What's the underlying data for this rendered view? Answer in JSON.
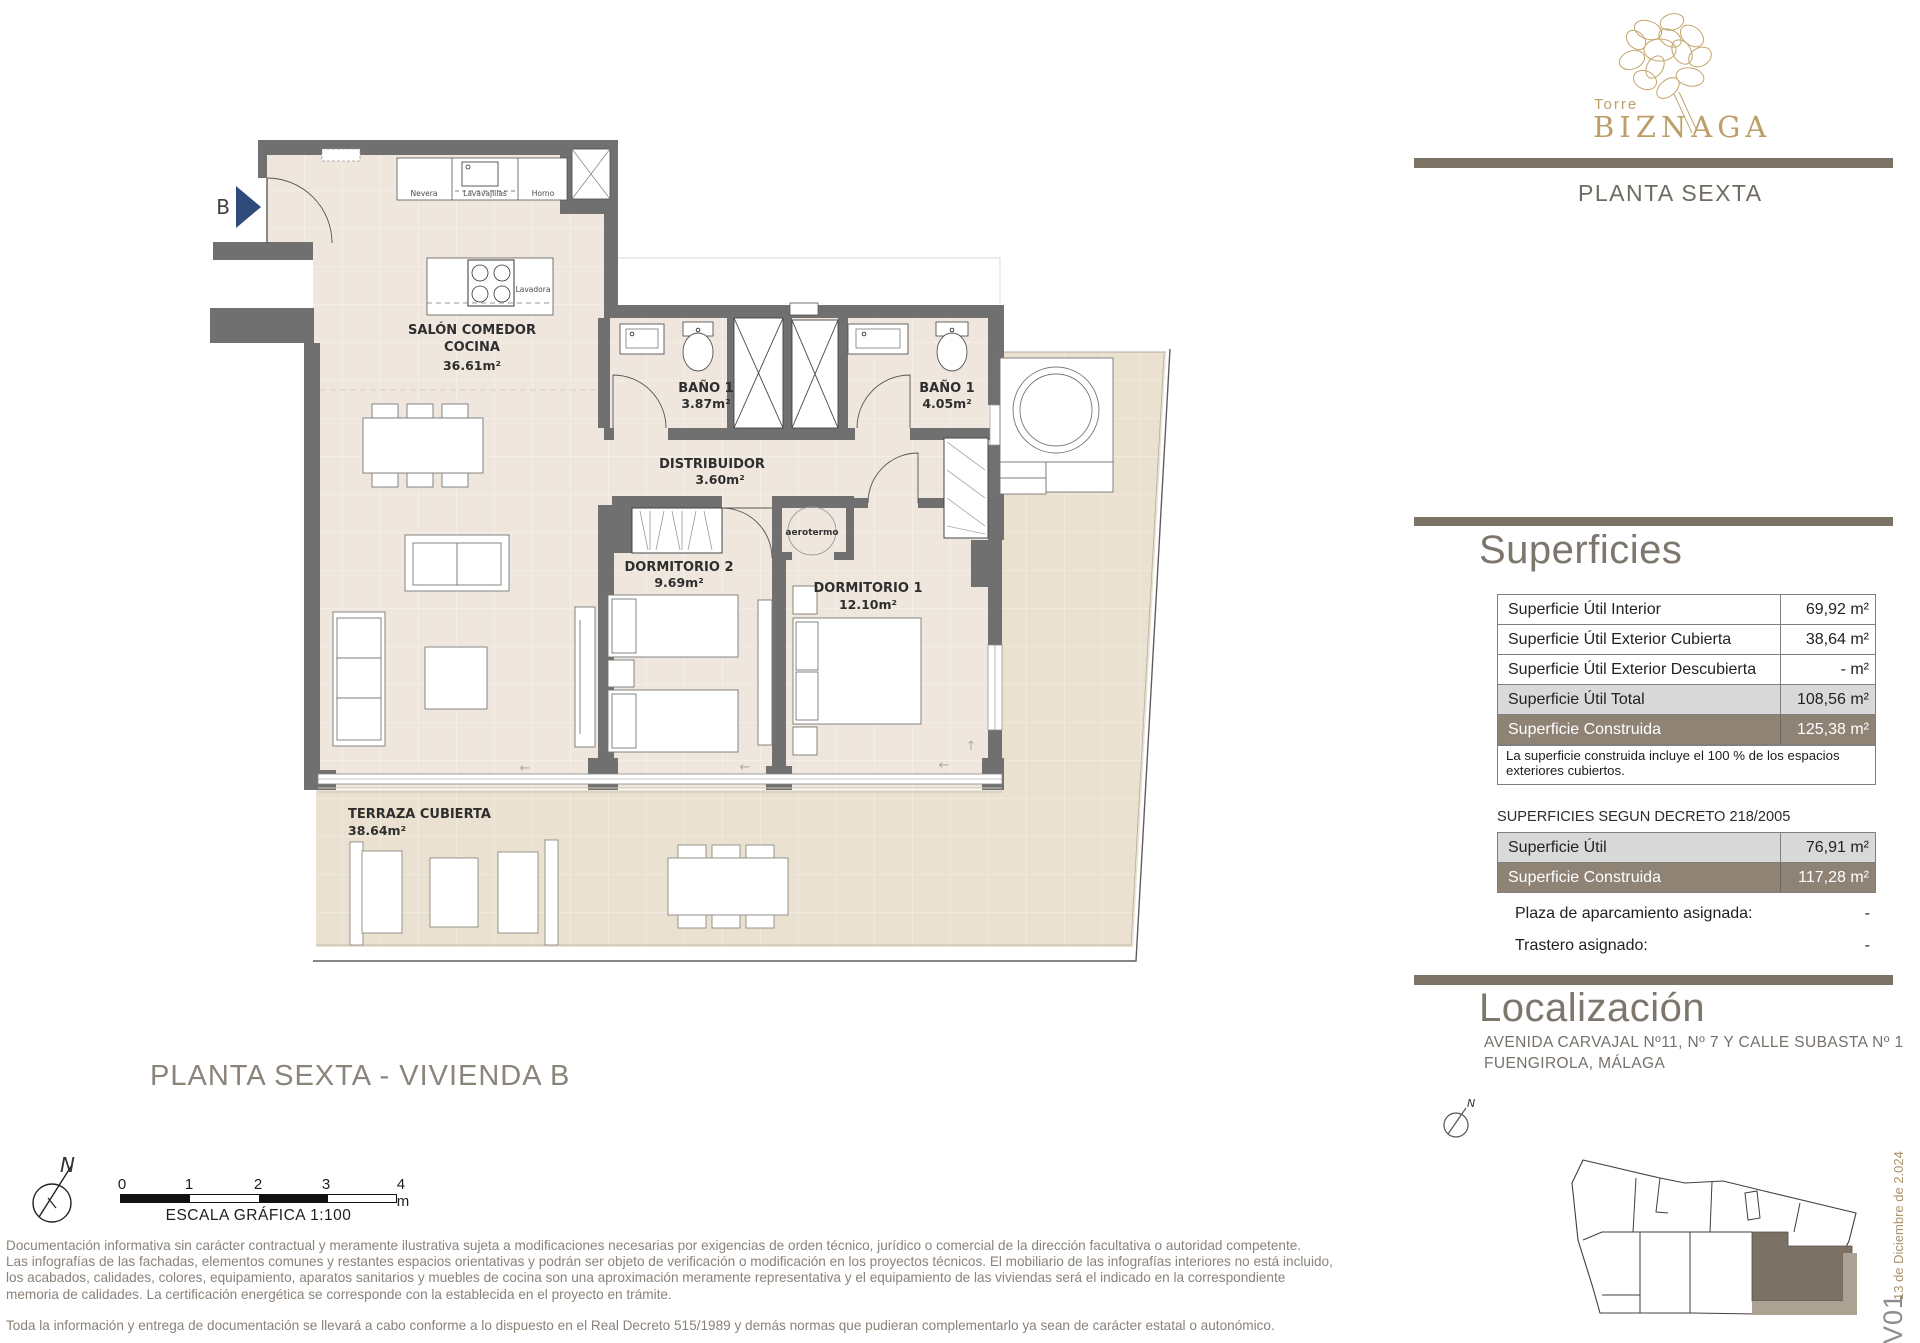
{
  "brand": {
    "top": "Torre",
    "name": "BIZNAGA",
    "floor": "PLANTA SEXTA"
  },
  "title": "PLANTA SEXTA - VIVIENDA B",
  "plan": {
    "entrance_label": "B",
    "rooms": [
      {
        "name": "SALÓN COMEDOR",
        "name2": "COCINA",
        "area": "36.61m²"
      },
      {
        "name": "BAÑO 1",
        "area": "3.87m²"
      },
      {
        "name": "BAÑO 1",
        "area": "4.05m²"
      },
      {
        "name": "DISTRIBUIDOR",
        "area": "3.60m²"
      },
      {
        "name": "DORMITORIO 2",
        "area": "9.69m²"
      },
      {
        "name": "DORMITORIO 1",
        "area": "12.10m²"
      },
      {
        "name": "TERRAZA CUBIERTA",
        "area": "38.64m²"
      }
    ],
    "appliances": {
      "fridge": "Nevera",
      "dishwasher": "Lavavajillas",
      "oven": "Horno",
      "washer": "Lavadora",
      "heater": "aerotermo"
    }
  },
  "north_label": "N",
  "scale_bar": {
    "ticks": [
      "0",
      "1",
      "2",
      "3",
      "4 m"
    ],
    "caption": "ESCALA GRÁFICA  1:100"
  },
  "superficies": {
    "heading": "Superficies",
    "rows": [
      {
        "label": "Superficie Útil Interior",
        "value": "69,92 m²"
      },
      {
        "label": "Superficie Útil Exterior Cubierta",
        "value": "38,64 m²"
      },
      {
        "label": "Superficie Útil Exterior Descubierta",
        "value": "- m²"
      },
      {
        "label": "Superficie Útil Total",
        "value": "108,56 m²"
      },
      {
        "label": "Superficie Construida",
        "value": "125,38 m²"
      }
    ],
    "note": "La superficie construida incluye el 100 % de los espacios exteriores cubiertos.",
    "decreto_title": "SUPERFICIES SEGUN DECRETO 218/2005",
    "decreto_rows": [
      {
        "label": "Superficie Útil",
        "value": "76,91 m²"
      },
      {
        "label": "Superficie Construida",
        "value": "117,28 m²"
      }
    ],
    "extras": [
      {
        "label": "Plaza de aparcamiento asignada:",
        "value": "-"
      },
      {
        "label": "Trastero asignado:",
        "value": "-"
      }
    ]
  },
  "localizacion": {
    "heading": "Localización",
    "address1": "AVENIDA CARVAJAL Nº11, Nº 7 Y CALLE SUBASTA Nº 1",
    "address2": "FUENGIROLA, MÁLAGA"
  },
  "version": {
    "code": "V01",
    "date": "13 de Diciembre de 2.024"
  },
  "disclaimer": {
    "lines": [
      "Documentación informativa sin carácter contractual  y  meramente ilustrativa sujeta  a  modificaciones necesarias por exigencias de orden técnico, jurídico  o  comercial de la dirección facultativa  o  autoridad competente.",
      "Las infografías de las fachadas, elementos comunes y restantes espacios orientativas y podrán ser objeto de verificación o modificación en los proyectos técnicos. El mobiliario de las infografías interiores no está incluido,",
      "los acabados,  calidades,  colores,  equipamiento,  aparatos sanitarios  y  muebles  de  cocina son una aproximación meramente representativa  y  el equipamiento de  las viviendas será el indicado en la correspondiente",
      "memoria de calidades. La certificación energética se corresponde con la establecida en el proyecto en trámite."
    ],
    "footer": "Toda la información y entrega de documentación se llevará a cabo conforme a lo dispuesto en el Real Decreto 515/1989 y demás normas que pudieran complementarlo ya sean de carácter estatal o autonómico."
  },
  "colors": {
    "accent_gold": "#BD9E66",
    "wall_gray": "#707070",
    "bar_taupe": "#7B7365",
    "row_brown": "#8E8375",
    "row_gray": "#D9D9D9",
    "floor_beige": "#EFE7DD",
    "terrace_khaki": "#EAE1D0",
    "arrow_blue": "#2F4B7C"
  }
}
